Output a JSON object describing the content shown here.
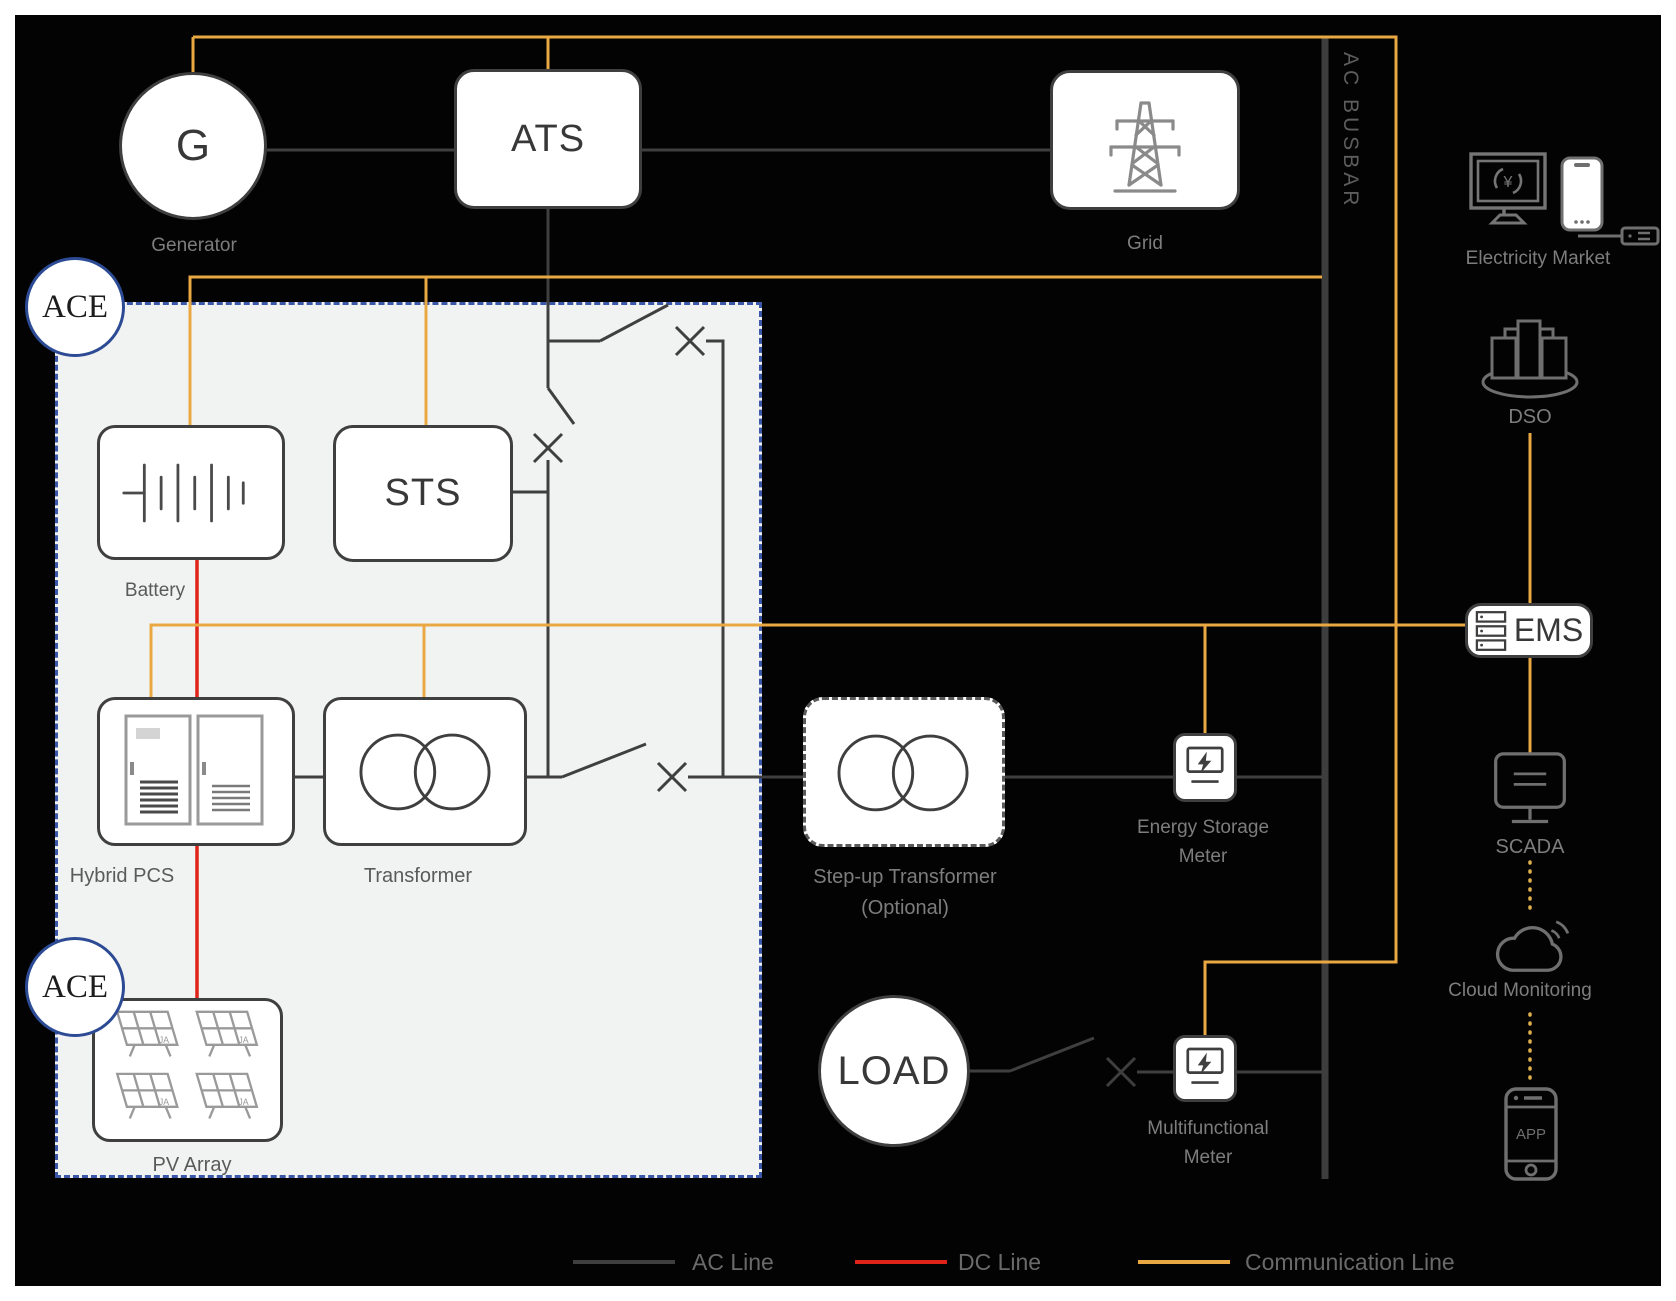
{
  "busbar_label": "AC BUSBAR",
  "ace_label": "ACE",
  "legend": {
    "ac_label": "AC Line",
    "dc_label": "DC Line",
    "comm_label": "Communication Line"
  },
  "nodes": {
    "generator": {
      "symbol": "G",
      "label": "Generator"
    },
    "ats": {
      "label": "ATS"
    },
    "grid": {
      "label": "Grid"
    },
    "battery": {
      "label": "Battery"
    },
    "sts": {
      "label": "STS"
    },
    "hybrid_pcs": {
      "label": "Hybrid PCS"
    },
    "transformer": {
      "label": "Transformer"
    },
    "pv_array": {
      "label": "PV Array"
    },
    "stepup_transformer": {
      "label": "Step-up Transformer",
      "sublabel": "(Optional)"
    },
    "energy_storage_meter": {
      "label_line1": "Energy Storage",
      "label_line2": "Meter"
    },
    "load": {
      "label": "LOAD"
    },
    "multifunctional_meter": {
      "label_line1": "Multifunctional",
      "label_line2": "Meter"
    },
    "electricity_market": {
      "label": "Electricity Market",
      "currency_symbol": "¥"
    },
    "dso": {
      "label": "DSO"
    },
    "ems": {
      "label": "EMS"
    },
    "scada": {
      "label": "SCADA"
    },
    "cloud_monitoring": {
      "label": "Cloud Monitoring"
    },
    "app": {
      "label": "APP"
    }
  },
  "colors": {
    "background": "#030303",
    "ac_line": "#3f3f3f",
    "dc_line": "#e02318",
    "communication_line": "#eaa843",
    "busbar": "#3d3d3d",
    "ace_border": "#3a57a8",
    "ace_fill": "#f1f3f2",
    "label_gray": "#7d7d7d"
  }
}
